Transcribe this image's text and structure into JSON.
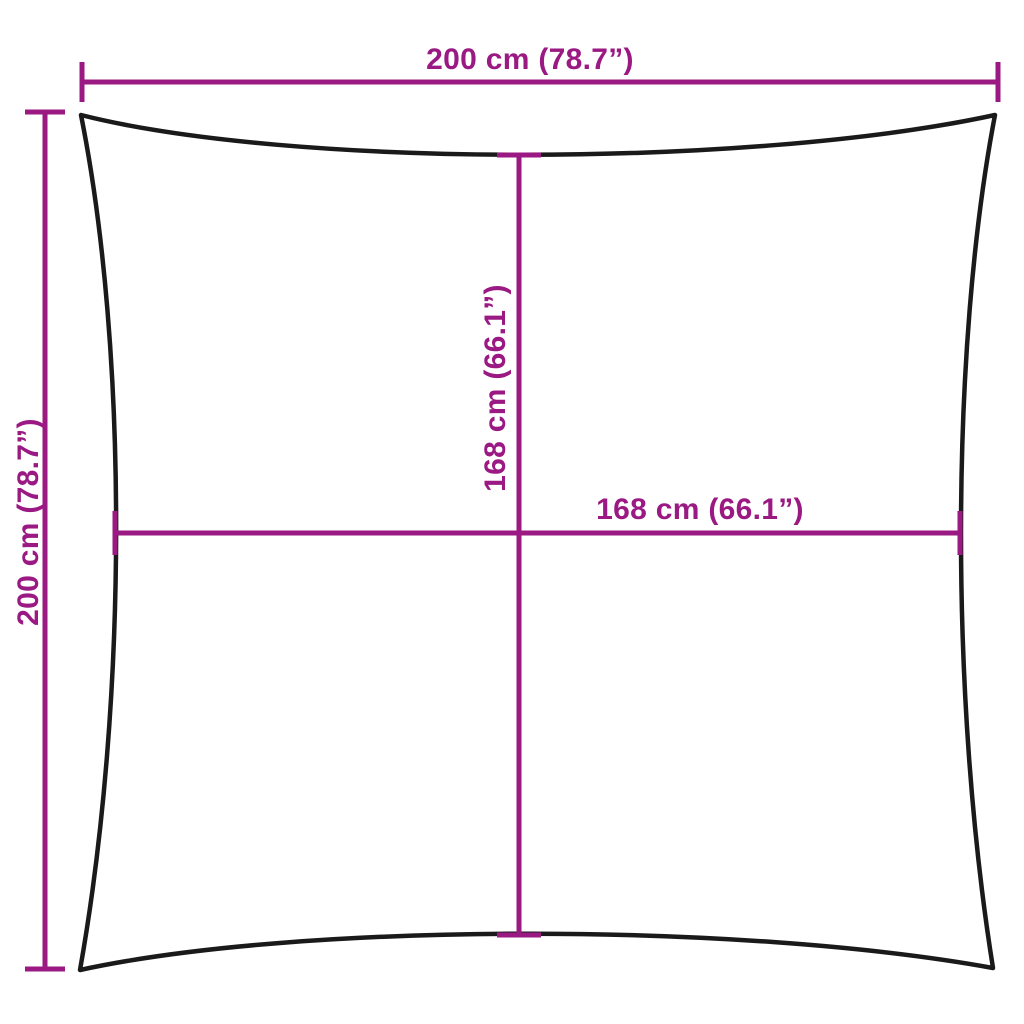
{
  "diagram": {
    "colors": {
      "dimension_lines": "#9A1982",
      "outline": "#1A1A1A",
      "background": "#FFFFFF"
    },
    "labels": {
      "top_width": "200 cm (78.7”)",
      "left_height": "200 cm (78.7”)",
      "inner_height": "168 cm (66.1”)",
      "inner_width": "168 cm (66.1”)"
    },
    "measurements": {
      "top_width": {
        "cm": 200,
        "inches": 78.7
      },
      "left_height": {
        "cm": 200,
        "inches": 78.7
      },
      "inner_height": {
        "cm": 168,
        "inches": 66.1
      },
      "inner_width": {
        "cm": 168,
        "inches": 66.1
      }
    }
  }
}
